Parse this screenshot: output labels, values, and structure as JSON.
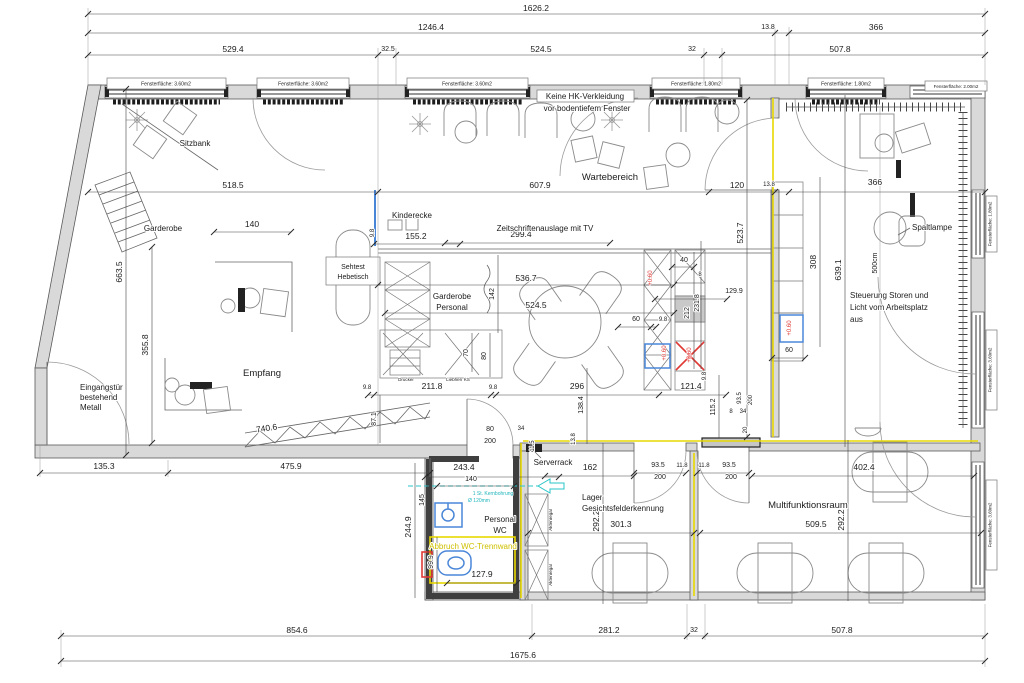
{
  "windows": {
    "top1": "Fensterfläche: 3.60m2",
    "top2": "Fensterfläche: 3.60m2",
    "top3": "Fensterfläche: 3.60m2",
    "top4": "Fensterfläche: 1.80m2",
    "top5": "Fensterfläche: 1.80m2",
    "corner": "Fensterfläche: 2.00m2",
    "right1": "Fensterfläche: 1.80m2",
    "right2": "Fensterfläche: 3.60m2",
    "right3": "Fensterfläche: 3.60m2"
  },
  "rooms": {
    "wartebereich": "Wartebereich",
    "empfang": "Empfang",
    "kinderecke": "Kinderecke",
    "garderobe": "Garderobe",
    "sitzbank": "Sitzbank",
    "gp1": "Garderobe",
    "gp2": "Personal",
    "wc1": "Personal",
    "wc2": "WC",
    "serverrack": "Serverrack",
    "lager1": "Lager",
    "lager2": "Gesichtsfelderkennung",
    "multi": "Multifunktionsraum",
    "spaltlampe": "Spaltlampe",
    "sehtest1": "Sehtest",
    "sehtest2": "Hebetisch"
  },
  "notes": {
    "hk1": "Keine HK-Verkleidung",
    "hk2": "vor bodentiefem Fenster",
    "zeit": "Zeitschriftenauslage mit TV",
    "ein1": "Eingangstür",
    "ein2": "bestehend",
    "ein3": "Metall",
    "st1": "Steuerung Storen und",
    "st2": "Licht vom Arbeitsplatz",
    "st3": "aus",
    "kb1": "1 St. Kernbohrung",
    "kb2": "Ø 120mm",
    "abbruch": "Abbruch WC-Trennwand",
    "drucker": "Drucker",
    "liebherr": "Liebherr KS",
    "akten": "Aktenregal",
    "cm500": "500cm",
    "elev": "+0.60"
  },
  "dims": {
    "t1": "1626.2",
    "t2": "1246.4",
    "t3": "529.4",
    "t4": "32.5",
    "t5": "524.5",
    "t6": "32",
    "t7": "507.8",
    "t8": "13.8",
    "t9": "366",
    "b1": "854.6",
    "b2": "281.2",
    "b3": "32",
    "b4": "507.8",
    "b5": "1675.6",
    "l1": "135.3",
    "l2": "475.9",
    "l3": "663.5",
    "l4": "355.8",
    "i_518": "518.5",
    "i_607": "607.9",
    "i_120": "120",
    "i_138": "13.8",
    "i_366": "366",
    "i_140a": "140",
    "i_155": "155.2",
    "i_98a": "9.8",
    "i_299": "299.4",
    "i_523": "523.7",
    "i_536": "536.7",
    "i_524": "524.5",
    "i_142": "142",
    "i_70": "70",
    "i_80": "80",
    "i_98b": "9.8",
    "i_211": "211.8",
    "i_98c": "9.8",
    "i_296": "296",
    "i_121": "121.4",
    "i_60a": "60",
    "i_98d": "9.8",
    "i_40": "40",
    "i_8a": "8",
    "i_129": "129.9",
    "i_212": "212",
    "i_231": "231.8",
    "i_87": "87.1",
    "i_98e": "9.8",
    "i_740": "740.6",
    "i_308": "308",
    "i_639": "639.1",
    "i_60b": "60",
    "i_115": "115.2",
    "i_935a": "93.5",
    "i_200a": "200",
    "i_8b": "8",
    "i_34a": "34",
    "i_20": "20",
    "i_80d": "80",
    "i_200d": "200",
    "i_34b": "34",
    "i_243": "243.4",
    "i_140b": "140",
    "i_145": "145",
    "i_244": "244.9",
    "i_99": "99.9",
    "i_127": "127.9",
    "i_138v": "138.4",
    "i_1138": "13.8",
    "i_115b": "11.5",
    "i_162": "162",
    "i_935b": "93.5",
    "i_118a": "11.8",
    "i_200b": "200",
    "i_118b": "11.8",
    "i_935c": "93.5",
    "i_200c": "200",
    "i_292a": "292.2",
    "i_301": "301.3",
    "i_292b": "292.2",
    "i_509": "509.5",
    "i_402": "402.4"
  },
  "colors": {
    "wall_fill": "#d9d9d9",
    "line": "#3a3a3a",
    "highlight_yellow": "#e8d800",
    "annotation_cyan": "#29c5c8",
    "annotation_red": "#e03a36",
    "fixture_blue": "#4a86d8"
  }
}
